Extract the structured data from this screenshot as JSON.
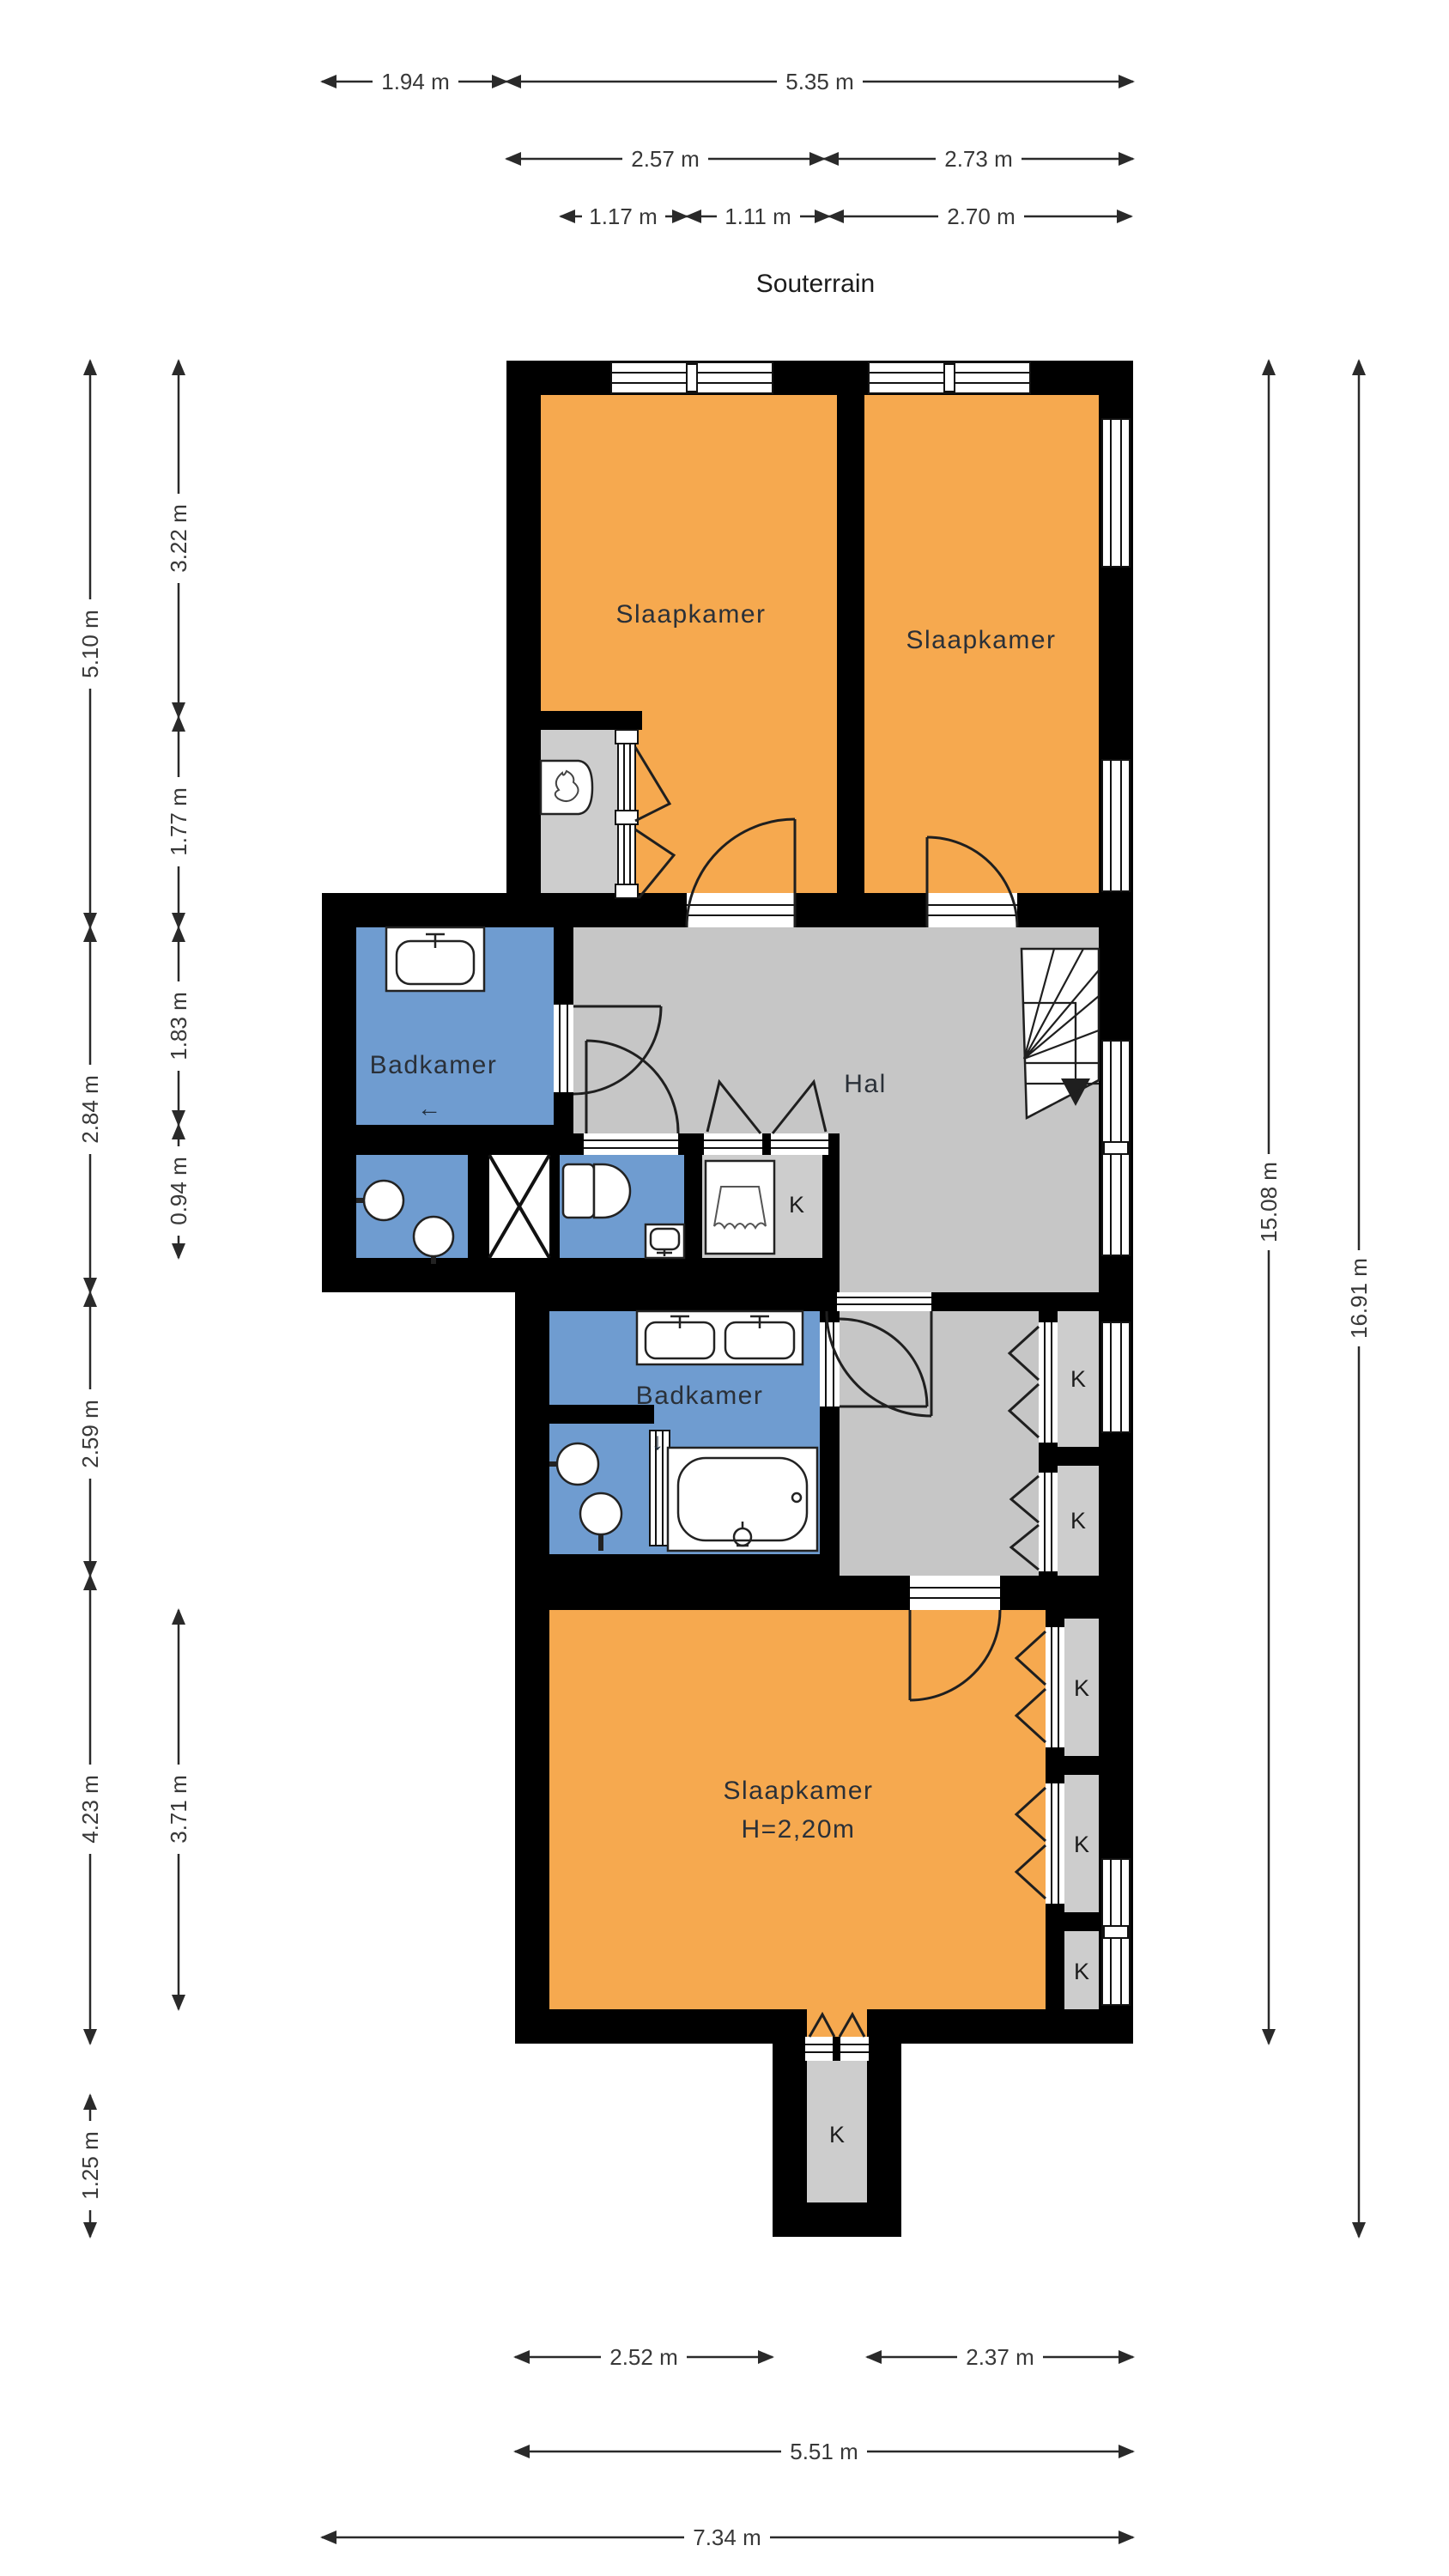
{
  "title": "Souterrain",
  "colors": {
    "wall": "#000000",
    "bedroom": "#F6A94F",
    "bathroom": "#6F9CD0",
    "hall": "#C6C6C6",
    "closet": "#CDCDCD",
    "shaft": "#FFFFFF"
  },
  "rooms": {
    "slaapkamer_top_left": "Slaapkamer",
    "slaapkamer_top_right": "Slaapkamer",
    "badkamer_upper": "Badkamer",
    "hal": "Hal",
    "badkamer_lower": "Badkamer",
    "slaapkamer_bottom": "Slaapkamer",
    "slaapkamer_bottom_height": "H=2,20m"
  },
  "closet_labels": {
    "hall": "K",
    "corridor_top": "K",
    "corridor_bottom": "K",
    "bedroom_top": "K",
    "bedroom_middle": "K",
    "bedroom_bottom": "K",
    "cellar": "K"
  },
  "symbols": {
    "badkamer_upper_arrow": "←",
    "badkamer_lower_arrow": "↓"
  },
  "dimensions": {
    "top": [
      {
        "label": "1.94 m"
      },
      {
        "label": "5.35 m"
      },
      {
        "label": "2.57 m"
      },
      {
        "label": "2.73 m"
      },
      {
        "label": "1.17 m"
      },
      {
        "label": "1.11 m"
      },
      {
        "label": "2.70 m"
      }
    ],
    "left_outer": [
      {
        "label": "5.10 m"
      },
      {
        "label": "2.84 m"
      },
      {
        "label": "2.59 m"
      },
      {
        "label": "4.23 m"
      },
      {
        "label": "1.25 m"
      }
    ],
    "left_inner": [
      {
        "label": "3.22 m"
      },
      {
        "label": "1.77 m"
      },
      {
        "label": "1.83 m"
      },
      {
        "label": "0.94 m"
      },
      {
        "label": "3.71 m"
      }
    ],
    "right": [
      {
        "label": "15.08 m"
      },
      {
        "label": "16.91 m"
      }
    ],
    "bottom": [
      {
        "label": "2.52 m"
      },
      {
        "label": "2.37 m"
      },
      {
        "label": "5.51 m"
      },
      {
        "label": "7.34 m"
      }
    ]
  }
}
